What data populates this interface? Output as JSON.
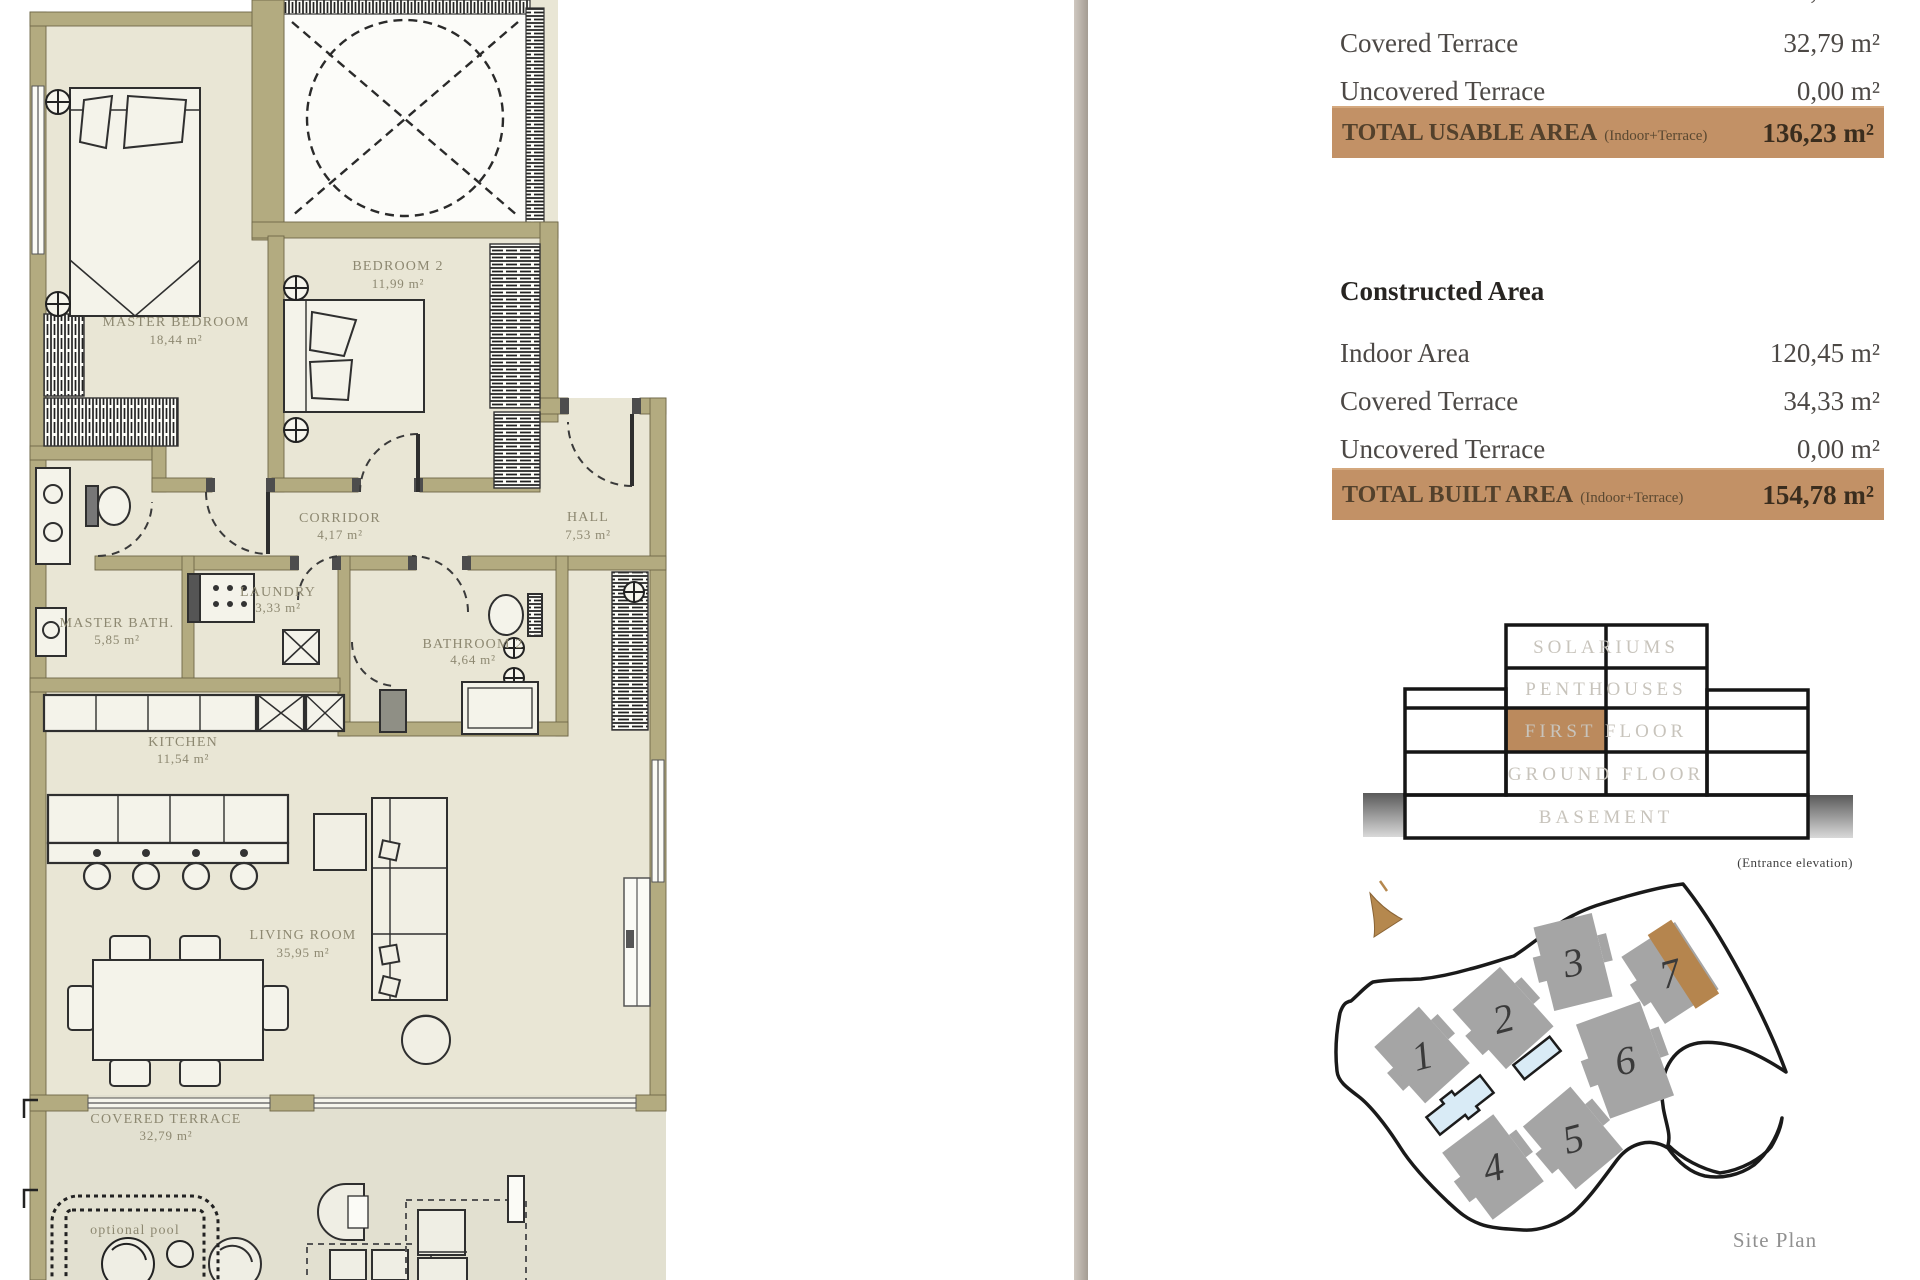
{
  "floor_plan": {
    "rooms": [
      {
        "name": "MASTER BEDROOM",
        "area": "18,44 m²"
      },
      {
        "name": "BEDROOM 2",
        "area": "11,99 m²"
      },
      {
        "name": "CORRIDOR",
        "area": "4,17 m²"
      },
      {
        "name": "HALL",
        "area": "7,53 m²"
      },
      {
        "name": "LAUNDRY",
        "area": "3,33 m²"
      },
      {
        "name": "MASTER BATH.",
        "area": "5,85 m²"
      },
      {
        "name": "BATHROOM 2",
        "area": "4,64 m²"
      },
      {
        "name": "KITCHEN",
        "area": "11,54 m²"
      },
      {
        "name": "LIVING ROOM",
        "area": "35,95 m²"
      },
      {
        "name": "COVERED TERRACE",
        "area": "32,79 m²"
      }
    ],
    "pool_label": "optional pool"
  },
  "usable_area": {
    "rows": [
      {
        "label": "Indoor Area",
        "value": "103,44 m²"
      },
      {
        "label": "Covered Terrace",
        "value": "32,79 m²"
      },
      {
        "label": "Uncovered Terrace",
        "value": "0,00 m²"
      }
    ],
    "total_label": "TOTAL USABLE AREA",
    "total_sub": "(Indoor+Terrace)",
    "total_value": "136,23 m²"
  },
  "constructed_area": {
    "title": "Constructed Area",
    "rows": [
      {
        "label": "Indoor Area",
        "value": "120,45 m²"
      },
      {
        "label": "Covered Terrace",
        "value": "34,33 m²"
      },
      {
        "label": "Uncovered Terrace",
        "value": "0,00 m²"
      }
    ],
    "total_label": "TOTAL BUILT AREA",
    "total_sub": "(Indoor+Terrace)",
    "total_value": "154,78 m²"
  },
  "elevation": {
    "floors": [
      "SOLARIUMS",
      "PENTHOUSES",
      "FIRST FLOOR",
      "GROUND FLOOR",
      "BASEMENT"
    ],
    "highlighted_floor": "FIRST FLOOR",
    "caption": "(Entrance elevation)"
  },
  "site_plan": {
    "buildings": [
      "1",
      "2",
      "3",
      "4",
      "5",
      "6",
      "7"
    ],
    "highlighted_building": "7",
    "label": "Site Plan"
  },
  "colors": {
    "accent_brown": "#c29166",
    "highlight_cell": "#bb8a5d",
    "wall_olive": "#b3ab80",
    "room_cream": "#e9e6d5",
    "building_gray": "#a5a5a5",
    "pool_blue": "#d9ebf6"
  }
}
